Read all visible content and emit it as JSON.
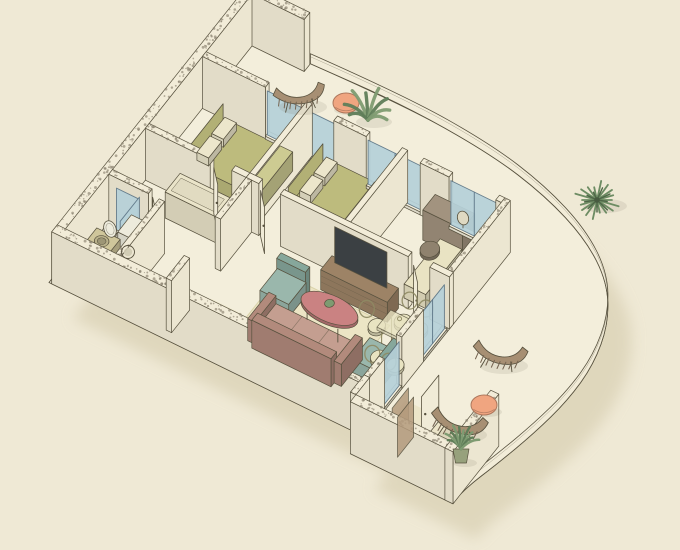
{
  "scene": {
    "title": "Isometric cutaway floor plan of an apartment with curved balcony",
    "width": 680,
    "height": 550
  },
  "colors": {
    "bg": "#efe9d5",
    "line": "#57513e",
    "floor": "#f3eedb",
    "wallTop": "#f2ecd8",
    "wallSW": "#e2dcc8",
    "wallSE": "#ece6d1",
    "speckle": "#8a8370",
    "glass": "#b6d1d9",
    "glassEdge": "#5d7687",
    "sill": "#f6f1df",
    "door": "#f0ebd7",
    "bedBase": "#a3a065",
    "blanket": "#bdbb7d",
    "sheet": "#cdcb92",
    "pillow": "#ece6cb",
    "headboard": "#b2b075",
    "cabinet": "#eae4c9",
    "desk": "#a2937f",
    "stool": "#8f826e",
    "daybed": "#e9e3c3",
    "console": "#9d8366",
    "tv": "#3b4043",
    "sofa": "#c49e90",
    "sofaDark": "#b28a7c",
    "armchair": "#9ab7ac",
    "armchairDark": "#86a79b",
    "coffee": "#ca8282",
    "rug": "#ece5c5",
    "rugEdge": "#d8d1a8",
    "mat": "#eee8c6",
    "matDark": "#e6dfba",
    "dining": "#e8e3c1",
    "diningEdge": "#8e8963",
    "vanity": "#cfc69b",
    "washer": "#edebdc",
    "sinkBowl": "#b9b18b",
    "lounger": "#a78f73",
    "pouf": "#f0a580",
    "plant": "#7e9b71",
    "plantDark": "#5f7d58",
    "palm": "#6d8c63",
    "pot": "#97a17c",
    "brownGlass": "#b49b7d",
    "shadow": "#d7ceb0"
  },
  "projection": {
    "ax": 0.9,
    "ay": 0.44,
    "bx": -0.62,
    "by": 0.78,
    "ox": 252,
    "oy": 46,
    "wall_height": 52
  },
  "outline_straight_head": [
    [
      -12,
      -12
    ],
    [
      58,
      -12
    ]
  ],
  "curve": [
    [
      58,
      -10
    ],
    [
      160,
      -14
    ],
    [
      260,
      -8
    ],
    [
      330,
      6
    ],
    [
      390,
      28
    ],
    [
      435,
      58
    ],
    [
      462,
      96
    ],
    [
      476,
      140
    ],
    [
      478,
      185
    ],
    [
      472,
      230
    ],
    [
      462,
      275
    ],
    [
      452,
      312
    ],
    [
      451,
      330
    ]
  ],
  "outline_straight_tail": [
    [
      451,
      332
    ],
    [
      338,
      332
    ],
    [
      338,
      310
    ],
    [
      -12,
      310
    ]
  ],
  "shadow_offset": {
    "dx": 24,
    "dy": 36
  },
  "mats": [
    {
      "name": "living-rug",
      "u": 168,
      "v": 196,
      "w": 120,
      "d": 92,
      "fill": "rug",
      "stroke": "rugEdge",
      "op": 1
    },
    {
      "name": "living-entry-mat",
      "u": 128,
      "v": 252,
      "w": 34,
      "d": 44,
      "fill": "mat",
      "op": 0.6
    },
    {
      "name": "entry-mat",
      "u": 348,
      "v": 258,
      "w": 66,
      "d": 50,
      "fill": "matDark",
      "op": 0.55
    }
  ],
  "walls": [
    {
      "name": "balcony-back-wall",
      "u": -9,
      "v": -9,
      "w": 67,
      "d": 9,
      "speckle": true
    },
    {
      "name": "nw-exterior-wall",
      "u": -9,
      "v": 0,
      "w": 9,
      "d": 310,
      "speckle": true
    },
    {
      "name": "sw-exterior-wall",
      "u": -9,
      "v": 301,
      "w": 349,
      "d": 9,
      "speckle": true
    },
    {
      "name": "entry-sw-wall",
      "u": 338,
      "v": 323,
      "w": 114,
      "d": 9,
      "speckle": true
    },
    {
      "name": "entry-se-wall",
      "u": 443,
      "v": 258,
      "w": 9,
      "d": 74,
      "speckle": true
    },
    {
      "name": "living-se-step-wall",
      "u": 332,
      "v": 301,
      "w": 6,
      "d": 22,
      "speckle": true
    },
    {
      "name": "ne-wall-solid",
      "u": 0,
      "v": 74,
      "w": 70,
      "d": 6,
      "speckle": true
    },
    {
      "name": "ne-wall-post-1",
      "u": 146,
      "v": 74,
      "w": 36,
      "d": 6,
      "speckle": true
    },
    {
      "name": "ne-wall-post-2",
      "u": 242,
      "v": 74,
      "w": 32,
      "d": 6,
      "speckle": true
    },
    {
      "name": "ne-wall-post-3",
      "u": 326,
      "v": 74,
      "w": 6,
      "d": 6
    },
    {
      "name": "bedroom-divider-wall",
      "u": 112,
      "v": 74,
      "w": 6,
      "d": 92
    },
    {
      "name": "bedroom-office-divider-wall",
      "u": 218,
      "v": 74,
      "w": 6,
      "d": 92
    },
    {
      "name": "master-south-wall-a",
      "u": 0,
      "v": 166,
      "w": 72,
      "d": 6,
      "speckle": true
    },
    {
      "name": "master-south-wall-b",
      "u": 96,
      "v": 166,
      "w": 16,
      "d": 6
    },
    {
      "name": "hall-south-wall",
      "u": 112,
      "v": 166,
      "w": 14,
      "d": 6
    },
    {
      "name": "living-north-wall",
      "u": 150,
      "v": 166,
      "w": 142,
      "d": 6
    },
    {
      "name": "living-north-wall-b",
      "u": 316,
      "v": 166,
      "w": 22,
      "d": 6
    },
    {
      "name": "corridor-wall-a",
      "u": 112,
      "v": 172,
      "w": 6,
      "d": 50,
      "speckle": true
    },
    {
      "name": "corridor-wall-b",
      "u": 112,
      "v": 272,
      "w": 6,
      "d": 29,
      "speckle": true
    },
    {
      "name": "bathroom-north-wall",
      "u": 0,
      "v": 225,
      "w": 44,
      "d": 6,
      "speckle": true
    },
    {
      "name": "bathroom-east-wall",
      "u": 56,
      "v": 231,
      "w": 6,
      "d": 70,
      "speckle": true
    },
    {
      "name": "se-wall-office",
      "u": 332,
      "v": 74,
      "w": 6,
      "d": 102,
      "speckle": true
    },
    {
      "name": "se-wall-mid",
      "u": 332,
      "v": 214,
      "w": 6,
      "d": 35,
      "speckle": true
    },
    {
      "name": "se-wall-south",
      "u": 332,
      "v": 277,
      "w": 6,
      "d": 24,
      "speckle": true
    }
  ],
  "glazings": [
    {
      "name": "master-bedroom-window",
      "a": [
        70,
        77
      ],
      "b": [
        146,
        77
      ],
      "mull": 108
    },
    {
      "name": "second-bedroom-window",
      "a": [
        182,
        77
      ],
      "b": [
        242,
        77
      ],
      "mull": 212
    },
    {
      "name": "office-window",
      "a": [
        274,
        77
      ],
      "b": [
        326,
        77
      ],
      "mull": 300
    },
    {
      "name": "balcony-door-glass",
      "a": [
        335,
        176
      ],
      "b": [
        335,
        214
      ],
      "mull": 195
    },
    {
      "name": "balcony-window-glass",
      "a": [
        335,
        249
      ],
      "b": [
        335,
        277
      ]
    },
    {
      "name": "shower-glass-a",
      "a": [
        34,
        231
      ],
      "b": [
        34,
        262
      ],
      "z1": 44
    },
    {
      "name": "shower-glass-b",
      "a": [
        10,
        233
      ],
      "b": [
        34,
        233
      ],
      "z1": 44
    }
  ],
  "screens": [
    {
      "name": "balcony-privacy-screen-1",
      "a": [
        368,
        282
      ],
      "b": [
        368,
        308
      ]
    },
    {
      "name": "balcony-privacy-screen-2",
      "a": [
        378,
        288
      ],
      "b": [
        378,
        314
      ]
    }
  ],
  "panels": [
    {
      "name": "tv-screen",
      "a": [
        218,
        183
      ],
      "b": [
        276,
        183
      ],
      "z0": 22,
      "z1": 58,
      "fill": "tv"
    },
    {
      "name": "master-bed-headboard",
      "a": [
        34,
        96
      ],
      "b": [
        34,
        154
      ],
      "z0": 0,
      "z1": 32,
      "fill": "headboard"
    },
    {
      "name": "second-bed-headboard",
      "a": [
        138,
        86
      ],
      "b": [
        138,
        142
      ],
      "z0": 0,
      "z1": 30,
      "fill": "headboard"
    }
  ],
  "doors": [
    {
      "name": "master-bedroom-door",
      "a": [
        76,
        172
      ],
      "b": [
        90,
        186
      ]
    },
    {
      "name": "second-bedroom-door",
      "a": [
        128,
        172
      ],
      "b": [
        142,
        186
      ]
    },
    {
      "name": "office-door",
      "a": [
        298,
        172
      ],
      "b": [
        312,
        186
      ]
    },
    {
      "name": "bathroom-door",
      "a": [
        46,
        227
      ],
      "b": [
        58,
        239
      ]
    },
    {
      "name": "entry-door",
      "a": [
        388,
        262
      ],
      "b": [
        388,
        290
      ]
    }
  ],
  "boxes": [
    {
      "name": "master-bed-base",
      "u": 34,
      "v": 96,
      "w": 78,
      "d": 58,
      "h": 11,
      "fill": "bedBase"
    },
    {
      "name": "master-bed-blanket",
      "u": 38,
      "v": 96,
      "w": 74,
      "d": 58,
      "h": 18,
      "fill": "blanket"
    },
    {
      "name": "master-bed-sheet-fold",
      "u": 98,
      "v": 97,
      "w": 14,
      "d": 56,
      "h": 19,
      "fill": "sheet"
    },
    {
      "name": "master-bed-pillow-1",
      "u": 40,
      "v": 102,
      "w": 13,
      "d": 21,
      "z": 18,
      "h": 8,
      "fill": "pillow"
    },
    {
      "name": "master-bed-pillow-2",
      "u": 40,
      "v": 126,
      "w": 13,
      "d": 21,
      "z": 18,
      "h": 8,
      "fill": "pillow"
    },
    {
      "name": "hall-cabinet",
      "u": 40,
      "v": 174,
      "w": 56,
      "d": 24,
      "h": 26,
      "fill": "cabinet",
      "topInset": true
    },
    {
      "name": "second-bed-base",
      "u": 138,
      "v": 86,
      "w": 72,
      "d": 56,
      "h": 11,
      "fill": "bedBase"
    },
    {
      "name": "second-bed-blanket",
      "u": 142,
      "v": 86,
      "w": 68,
      "d": 56,
      "h": 17,
      "fill": "blanket"
    },
    {
      "name": "second-bed-sheet-fold",
      "u": 196,
      "v": 87,
      "w": 14,
      "d": 54,
      "h": 18,
      "fill": "sheet"
    },
    {
      "name": "second-bed-pillow-1",
      "u": 146,
      "v": 92,
      "w": 12,
      "d": 20,
      "z": 17,
      "h": 8,
      "fill": "pillow"
    },
    {
      "name": "second-bed-pillow-2",
      "u": 146,
      "v": 115,
      "w": 12,
      "d": 20,
      "z": 17,
      "h": 8,
      "fill": "pillow"
    },
    {
      "name": "office-desk",
      "u": 260,
      "v": 82,
      "w": 44,
      "d": 20,
      "h": 30,
      "fill": "desk"
    },
    {
      "name": "office-daybed",
      "u": 282,
      "v": 106,
      "w": 24,
      "d": 58,
      "h": 14,
      "fill": "daybed"
    },
    {
      "name": "tv-console",
      "u": 210,
      "v": 176,
      "w": 74,
      "d": 18,
      "h": 20,
      "fill": "console",
      "drawers": true
    },
    {
      "name": "sofa-seat",
      "u": 192,
      "v": 240,
      "w": 88,
      "d": 32,
      "h": 14,
      "fill": "sofa",
      "seams": [
        221,
        251
      ]
    },
    {
      "name": "sofa-back",
      "u": 192,
      "v": 270,
      "w": 88,
      "d": 9,
      "h": 28,
      "fill": "sofaDark"
    },
    {
      "name": "sofa-arm-left",
      "u": 184,
      "v": 240,
      "w": 8,
      "d": 34,
      "h": 22,
      "fill": "sofaDark"
    },
    {
      "name": "sofa-arm-right",
      "u": 280,
      "v": 240,
      "w": 8,
      "d": 34,
      "h": 22,
      "fill": "sofaDark"
    },
    {
      "name": "armchair-1-seat",
      "u": 170,
      "v": 206,
      "w": 32,
      "d": 28,
      "h": 13,
      "fill": "armchair"
    },
    {
      "name": "armchair-1-back",
      "u": 170,
      "v": 200,
      "w": 32,
      "d": 7,
      "h": 24,
      "fill": "armchairDark"
    },
    {
      "name": "armchair-2-seat",
      "u": 288,
      "v": 228,
      "w": 26,
      "d": 28,
      "h": 13,
      "fill": "armchair"
    },
    {
      "name": "armchair-2-back",
      "u": 314,
      "v": 228,
      "w": 7,
      "d": 28,
      "h": 24,
      "fill": "armchairDark"
    },
    {
      "name": "bathroom-vanity",
      "u": 8,
      "v": 262,
      "w": 26,
      "d": 24,
      "h": 26,
      "fill": "vanity"
    },
    {
      "name": "washing-machine",
      "u": 30,
      "v": 238,
      "w": 22,
      "d": 22,
      "h": 30,
      "fill": "washer"
    },
    {
      "name": "toilet-base",
      "u": 6,
      "v": 241,
      "w": 12,
      "d": 13,
      "h": 11,
      "fill": "washer"
    },
    {
      "name": "window-sill-1",
      "u": 70,
      "v": 74,
      "w": 76,
      "d": 6,
      "h": 3,
      "fill": "sill"
    },
    {
      "name": "window-sill-2",
      "u": 182,
      "v": 74,
      "w": 60,
      "d": 6,
      "h": 3,
      "fill": "sill"
    },
    {
      "name": "window-sill-3",
      "u": 274,
      "v": 74,
      "w": 52,
      "d": 6,
      "h": 3,
      "fill": "sill"
    },
    {
      "name": "balcony-door-sill",
      "u": 332,
      "v": 176,
      "w": 6,
      "d": 38,
      "h": 3,
      "fill": "sill"
    },
    {
      "name": "balcony-window-sill",
      "u": 332,
      "v": 249,
      "w": 6,
      "d": 28,
      "h": 3,
      "fill": "sill"
    }
  ],
  "discs": [
    {
      "name": "coffee-table",
      "cu": 239,
      "cv": 222,
      "rx": 30,
      "ry": 14,
      "h": 16,
      "fill": "coffee",
      "rim": true,
      "legs": 3
    },
    {
      "name": "coffee-table-plant",
      "cu": 239,
      "cv": 222,
      "rx": 4.5,
      "ry": 4.5,
      "z": 16,
      "h": 5,
      "fill": "plant"
    },
    {
      "name": "office-stool",
      "cu": 283,
      "cv": 124,
      "rx": 9,
      "ry": 9,
      "h": 18,
      "fill": "stool",
      "rim": true
    },
    {
      "name": "sink-bowl",
      "cu": 21,
      "cv": 273,
      "rx": 7,
      "ry": 6,
      "z": 26,
      "h": 1,
      "fill": "sinkBowl",
      "inner": 0.6
    },
    {
      "name": "toilet-bowl",
      "cu": 12,
      "cv": 248,
      "rx": 6.5,
      "ry": 7,
      "h": 13,
      "fill": "washer",
      "rim": true
    }
  ],
  "dining": {
    "name": "dining-set",
    "table": {
      "u": 296,
      "v": 206,
      "w": 40,
      "d": 22,
      "topZ": 24,
      "topH": 3
    },
    "chairs": [
      {
        "cu": 304,
        "cv": 198,
        "du": 0,
        "dv": -1
      },
      {
        "cu": 322,
        "cv": 198,
        "du": 0,
        "dv": -1
      },
      {
        "cu": 308,
        "cv": 242,
        "du": 0,
        "dv": 1
      },
      {
        "cu": 326,
        "cv": 242,
        "du": 0,
        "dv": 1
      },
      {
        "cu": 286,
        "cv": 214,
        "du": -1,
        "dv": 0
      }
    ],
    "glasses": [
      [
        310,
        212
      ],
      [
        321,
        218
      ]
    ]
  },
  "deco": [
    {
      "type": "lounger",
      "name": "hanging-lounge-chair-top",
      "x": 299,
      "y": 93,
      "rot": -5,
      "s": 1
    },
    {
      "type": "lounger",
      "name": "lounge-chair-right",
      "x": 500,
      "y": 352,
      "rot": 12,
      "s": 1.05
    },
    {
      "type": "lounger",
      "name": "lounge-chair-bottom",
      "x": 459,
      "y": 421,
      "rot": 16,
      "s": 1.1
    },
    {
      "type": "pouf",
      "name": "pouf-top",
      "x": 346,
      "y": 103,
      "rx": 13,
      "ry": 10
    },
    {
      "type": "pouf",
      "name": "pouf-bottom",
      "x": 484,
      "y": 405,
      "rx": 13,
      "ry": 10
    },
    {
      "type": "plant",
      "name": "balcony-plant-top",
      "x": 368,
      "y": 118,
      "s": 1.05
    },
    {
      "type": "palm",
      "name": "balcony-palm",
      "x": 597,
      "y": 200,
      "s": 1.15
    },
    {
      "type": "potted",
      "name": "balcony-plant-bottom",
      "x": 461,
      "y": 447,
      "s": 1
    },
    {
      "type": "mirror",
      "name": "desk-mirror",
      "x": 463,
      "y": 218
    },
    {
      "type": "toiletlid",
      "name": "toilet-lid",
      "x": 110,
      "y": 229
    },
    {
      "type": "washerdoor",
      "name": "washer-door",
      "x": 128,
      "y": 252
    }
  ]
}
